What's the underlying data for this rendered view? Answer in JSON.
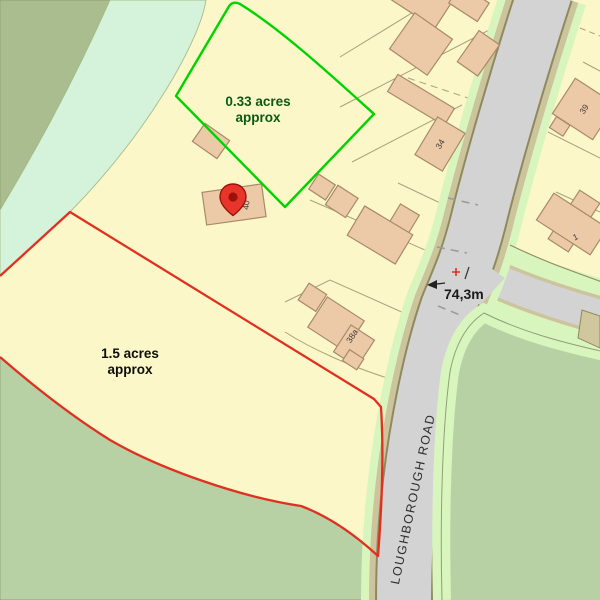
{
  "map": {
    "parcels": {
      "green": {
        "line1": "0.33 acres",
        "line2": "approx",
        "boundary_color": "#00d400",
        "text_color": "#0a5a14"
      },
      "red": {
        "line1": "1.5 acres",
        "line2": "approx",
        "boundary_color": "#e03020",
        "text_color": "#0d0d0d"
      }
    },
    "road": {
      "name": "LOUGHBOROUGH ROAD"
    },
    "spot_height": {
      "value": "74,3m",
      "marker": "+"
    },
    "buildings": {
      "b40": "40",
      "b34": "34",
      "b38a": "38a",
      "b39": "39",
      "b1": "1"
    },
    "icons": {
      "pin": "map-pin"
    },
    "colors": {
      "background_parcel": "#fbf7c8",
      "woodland_dark": "#a9bd8f",
      "woodland_light": "#d5f2da",
      "field_green": "#b8d1a4",
      "verge_light_green": "#d8f5bd",
      "hedge_olive": "#ccc49c",
      "road_gray": "#d4d3d4",
      "building_fill": "#edcaa7",
      "pin_red": "#e8352b"
    }
  }
}
